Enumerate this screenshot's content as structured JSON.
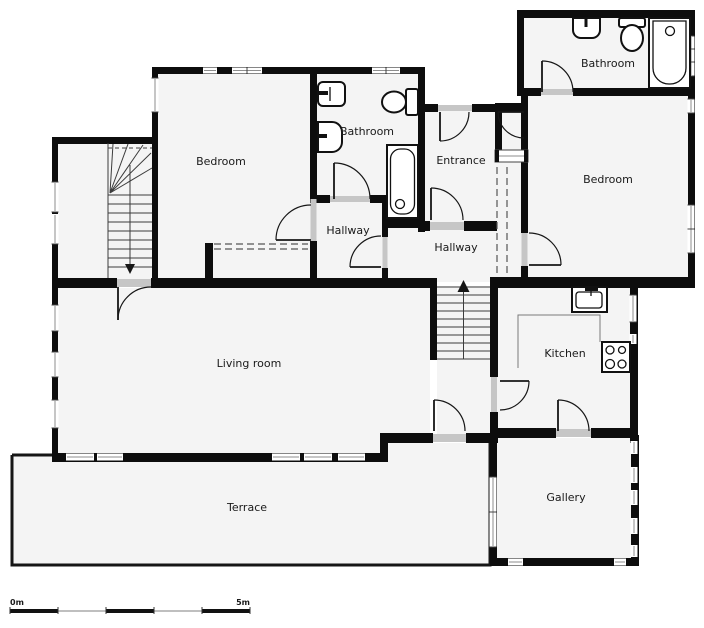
{
  "rooms": [
    {
      "id": "bedroom-1",
      "label": "Bedroom"
    },
    {
      "id": "bathroom-1",
      "label": "Bathroom"
    },
    {
      "id": "entrance",
      "label": "Entrance"
    },
    {
      "id": "bathroom-2",
      "label": "Bathroom"
    },
    {
      "id": "bedroom-2",
      "label": "Bedroom"
    },
    {
      "id": "hallway-1",
      "label": "Hallway"
    },
    {
      "id": "hallway-2",
      "label": "Hallway"
    },
    {
      "id": "living-room",
      "label": "Living room"
    },
    {
      "id": "kitchen",
      "label": "Kitchen"
    },
    {
      "id": "gallery",
      "label": "Gallery"
    },
    {
      "id": "terrace",
      "label": "Terrace"
    }
  ],
  "fixtures": {
    "bathroom_1": [
      "sink",
      "sink",
      "toilet",
      "bathtub"
    ],
    "bathroom_2": [
      "sink",
      "toilet",
      "bathtub"
    ],
    "kitchen": [
      "kitchen-sink",
      "stove-4-burners",
      "counter"
    ],
    "bedroom_1": [
      "closet-dashed"
    ],
    "entrance": [
      "closet-dashed"
    ]
  },
  "staircases": [
    {
      "id": "stairwell-upper-left",
      "direction": "down"
    },
    {
      "id": "stairs-center",
      "direction": "up"
    }
  ],
  "scale_bar": {
    "start_label": "0m",
    "end_label": "5m",
    "segments": 5
  },
  "colors": {
    "wall": "#0d0d0d",
    "floor": "#f4f4f4",
    "background": "#ffffff",
    "door_sill": "#c6c6c6",
    "label_text": "#1a1a1a"
  }
}
